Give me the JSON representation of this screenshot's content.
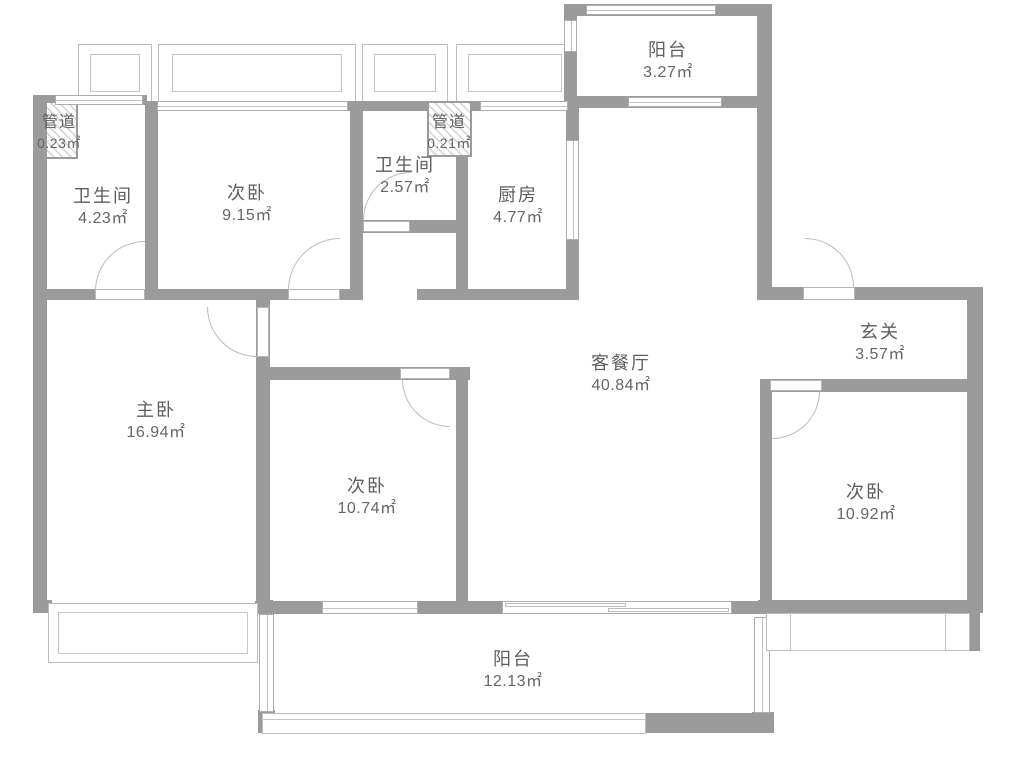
{
  "plan": {
    "type": "apartment-floor-plan",
    "colors": {
      "wall": "#9b9b9b",
      "thin_line": "#bdbdbd",
      "text": "#5e5e5e",
      "background": "#ffffff"
    },
    "rooms": {
      "duct_top_left": {
        "name": "管道",
        "area": "0.23㎡"
      },
      "bath_left": {
        "name": "卫生间",
        "area": "4.23㎡"
      },
      "bedroom_top": {
        "name": "次卧",
        "area": "9.15㎡"
      },
      "bath_mid": {
        "name": "卫生间",
        "area": "2.57㎡"
      },
      "duct_mid": {
        "name": "管道",
        "area": "0.21㎡"
      },
      "kitchen": {
        "name": "厨房",
        "area": "4.77㎡"
      },
      "balcony_top": {
        "name": "阳台",
        "area": "3.27㎡"
      },
      "entry": {
        "name": "玄关",
        "area": "3.57㎡"
      },
      "living_dining": {
        "name": "客餐厅",
        "area": "40.84㎡"
      },
      "master_bedroom": {
        "name": "主卧",
        "area": "16.94㎡"
      },
      "bedroom_mid": {
        "name": "次卧",
        "area": "10.74㎡"
      },
      "bedroom_right": {
        "name": "次卧",
        "area": "10.92㎡"
      },
      "balcony_bottom": {
        "name": "阳台",
        "area": "12.13㎡"
      }
    }
  }
}
